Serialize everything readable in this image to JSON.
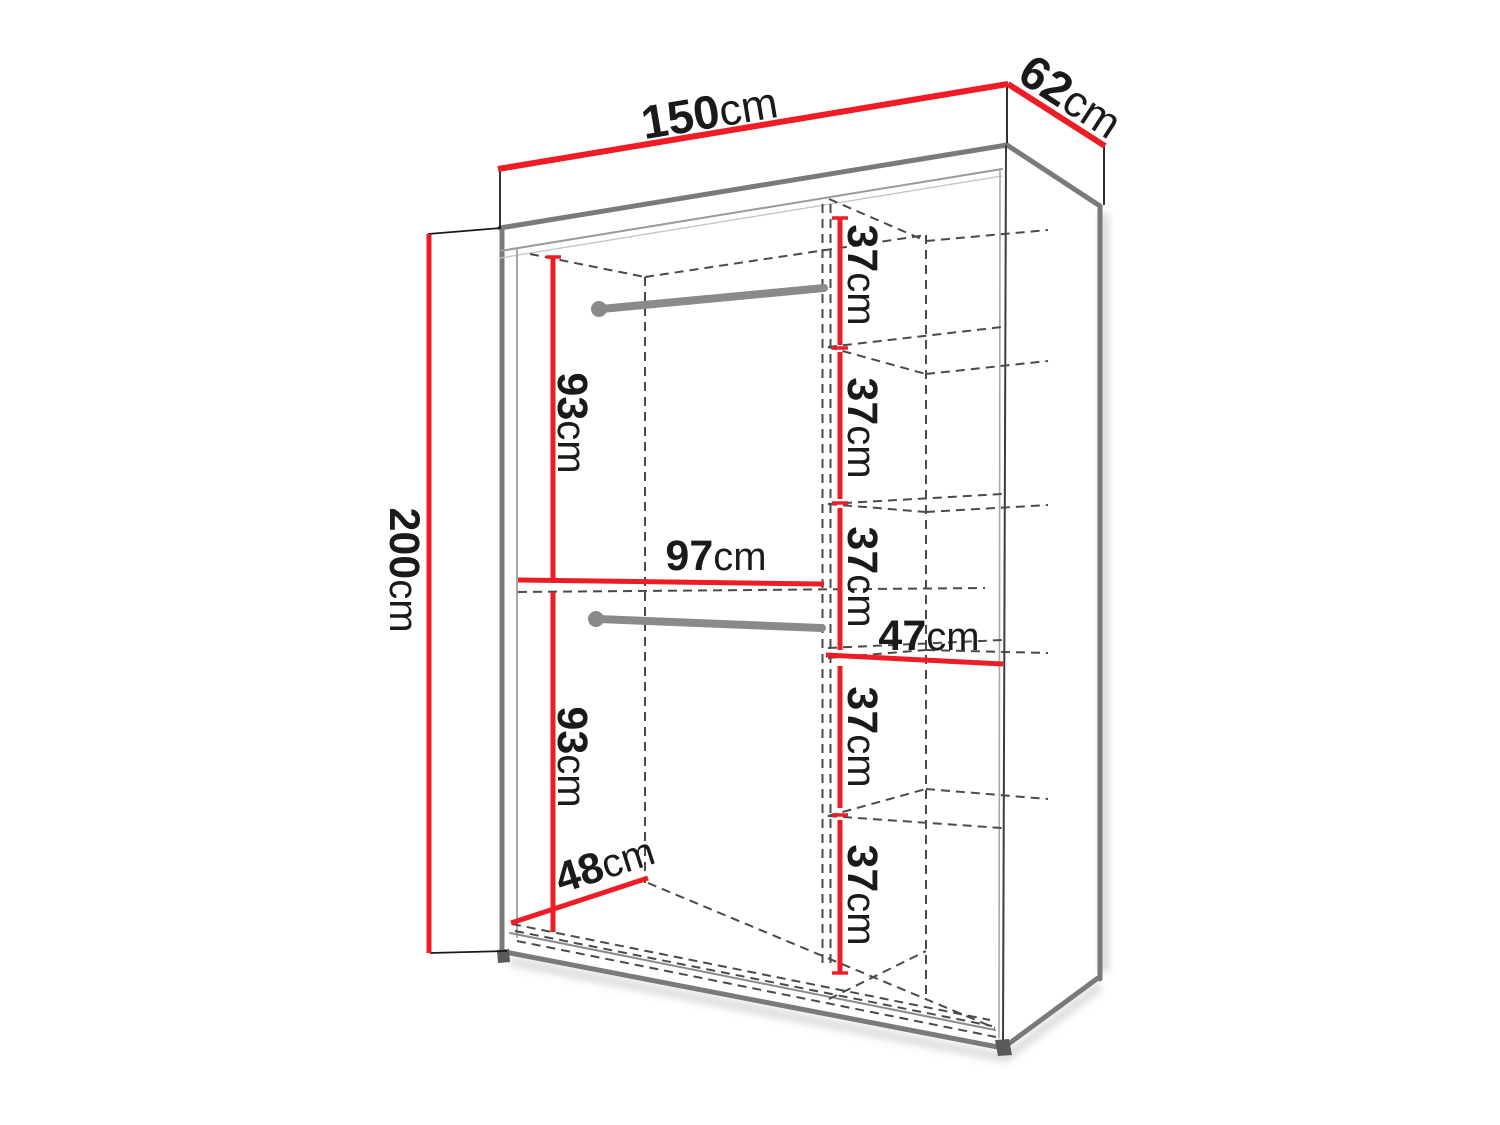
{
  "diagram": {
    "subject": "wardrobe",
    "view": "perspective line drawing with dimensions",
    "accent_color": "#ee1c25",
    "edge_color": "#7a7a7a",
    "dash_color": "#4a4a4a",
    "text_color": "#1a1a1a",
    "labels": {
      "width": {
        "value": "150",
        "unit": "cm"
      },
      "depth": {
        "value": "62",
        "unit": "cm"
      },
      "height": {
        "value": "200",
        "unit": "cm"
      },
      "top_hanging_height": {
        "value": "93",
        "unit": "cm"
      },
      "bottom_hanging_height": {
        "value": "93",
        "unit": "cm"
      },
      "hanging_section_width": {
        "value": "97",
        "unit": "cm"
      },
      "shelf_section_width": {
        "value": "47",
        "unit": "cm"
      },
      "interior_depth": {
        "value": "48",
        "unit": "cm"
      },
      "shelf_compartments": [
        {
          "value": "37",
          "unit": "cm"
        },
        {
          "value": "37",
          "unit": "cm"
        },
        {
          "value": "37",
          "unit": "cm"
        },
        {
          "value": "37",
          "unit": "cm"
        },
        {
          "value": "37",
          "unit": "cm"
        }
      ]
    }
  }
}
